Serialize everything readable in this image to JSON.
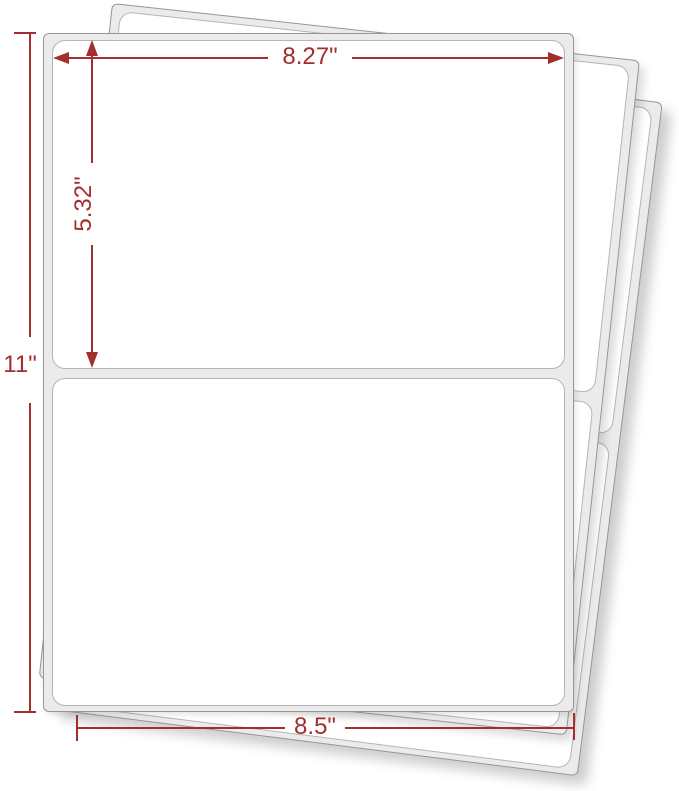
{
  "image": {
    "type": "product-dimension-diagram",
    "subject": "Fanned stack of half-sheet shipping label sheets"
  },
  "sheets": {
    "count": 3,
    "labels_per_sheet": 2
  },
  "annotations": {
    "label_width": "8.27\"",
    "label_height": "5.32\"",
    "sheet_height": "11\"",
    "sheet_width": "8.5\""
  },
  "colors": {
    "dimension_red": "#a22e2e",
    "sheet_fill": "#ebebeb",
    "label_fill": "#ffffff",
    "sheet_border": "#979797",
    "label_border": "#b5b5b5",
    "background": "#ffffff"
  }
}
